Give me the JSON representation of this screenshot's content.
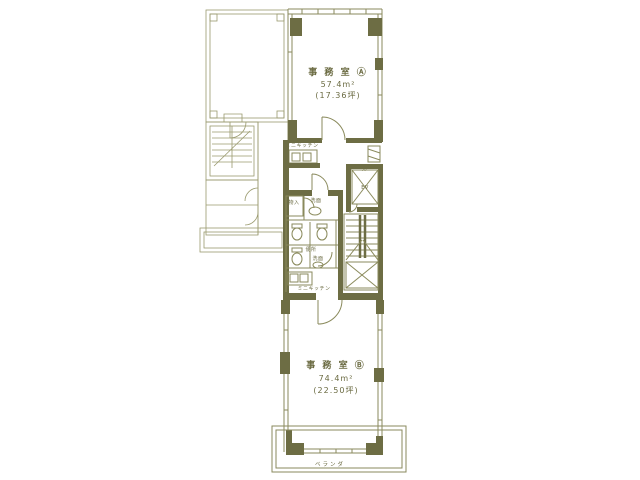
{
  "plan": {
    "colors": {
      "line": "#8a8a5c",
      "wall_fill": "#6d6d44",
      "text": "#6b6b42",
      "background": "#ffffff"
    },
    "office_a": {
      "title": "事 務 室 Ⓐ",
      "area": "57.4m²",
      "tsubo": "(17.36坪)"
    },
    "office_b": {
      "title": "事 務 室 Ⓑ",
      "area": "74.4m²",
      "tsubo": "(22.50坪)"
    },
    "labels": {
      "hall": "ホール",
      "elevator": "EV",
      "mini_kitchen_upper": "ミニキッチン",
      "mini_kitchen_lower": "ミニキッチン",
      "storage": "物入",
      "washroom_upper": "洗面",
      "toilet": "便所",
      "washroom_lower": "洗面",
      "veranda": "ベランダ"
    }
  }
}
